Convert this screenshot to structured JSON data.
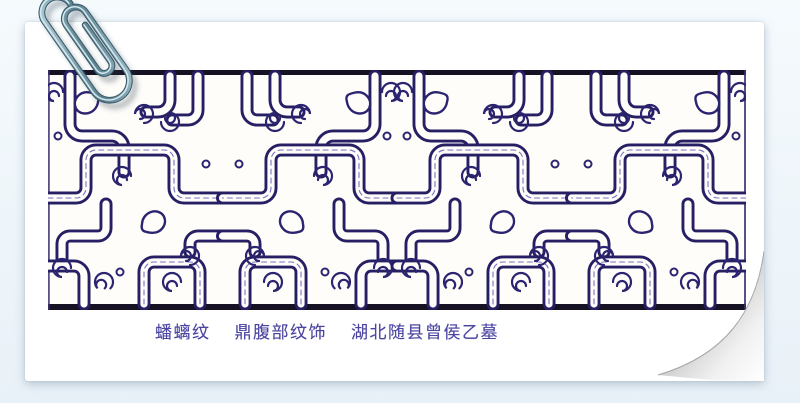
{
  "scene": {
    "description": "Scanned illustration card of an interlaced bronze pattern, pinned with a paperclip, page curl at bottom right",
    "background_color": "#eef5fa"
  },
  "card": {
    "paper_color": "#ffffff"
  },
  "paperclip": {
    "icon": "paperclip-icon",
    "wire_color": "#6f95a4"
  },
  "pattern_band": {
    "name": "panchi interlaced dragon pattern band",
    "line_color": "#2b2470",
    "frame_color": "#161223",
    "paper_color": "#fffdfa"
  },
  "caption": {
    "full_text": "蟠螭纹　鼎腹部纹饰　湖北随县曾侯乙墓",
    "segments": [
      "蟠螭纹",
      "鼎腹部纹饰",
      "湖北随县曾侯乙墓"
    ],
    "text_color": "#4b45a1"
  }
}
